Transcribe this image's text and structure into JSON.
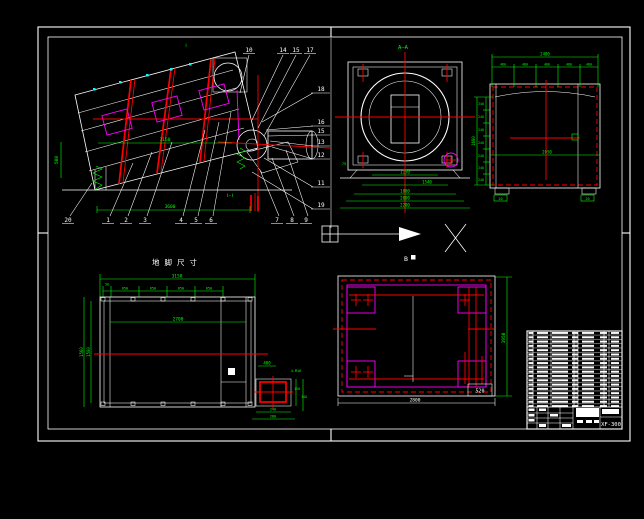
{
  "palette": {
    "bg": "#000000",
    "line": "#ffffff",
    "dim": "#00ff00",
    "center": "#ff0000",
    "panel": "#ff00ff",
    "dot": "#00ffff"
  },
  "side_view": {
    "dim_inner": "3150",
    "dim_base": "3600",
    "dim_left": "500",
    "section_label": "Ⅰ-Ⅰ",
    "section_mark": "Ⅰ",
    "balloons_bottom": [
      "20",
      "1",
      "2",
      "3",
      "4",
      "5",
      "6"
    ],
    "balloons_bottom_right": [
      "7",
      "8",
      "9"
    ],
    "balloons_top": [
      "10",
      "14",
      "15",
      "17"
    ],
    "balloons_right": [
      "18",
      "16",
      "15",
      "13",
      "12",
      "11",
      "19"
    ]
  },
  "section_view": {
    "label": "A—A",
    "dims": [
      "1150",
      "1540",
      "1800",
      "2000",
      "2200"
    ],
    "dim_side": "75"
  },
  "end_view": {
    "dim_top_total": "2400",
    "dims_top": [
      "480",
      "480",
      "480",
      "480",
      "480"
    ],
    "dim_left_total": "1680",
    "dims_left": [
      "240",
      "240",
      "240",
      "240",
      "240",
      "240",
      "240"
    ],
    "dim_inner": "2050",
    "foot_label_left": "20",
    "foot_label_right": "20"
  },
  "foundation_view": {
    "title": "地脚尺寸",
    "dim_total": "3150",
    "dim_chain_start": "50",
    "dims_chain": [
      "650",
      "650",
      "650",
      "650"
    ],
    "dim_left_outer": "1560",
    "dim_left_inner": "1500",
    "dim_inner": "2700",
    "detail": {
      "dim_top": "400",
      "bolt_label": "4-M16",
      "dim_right_1": "150",
      "dim_right_2": "140",
      "dim_bottom_1": "240",
      "dim_bottom_2": "280"
    }
  },
  "b_view": {
    "label": "B",
    "dim_right": "1950",
    "dim_bottom": "2800",
    "tag": "520"
  },
  "title_block": {
    "drawing_no": "XF-300"
  }
}
